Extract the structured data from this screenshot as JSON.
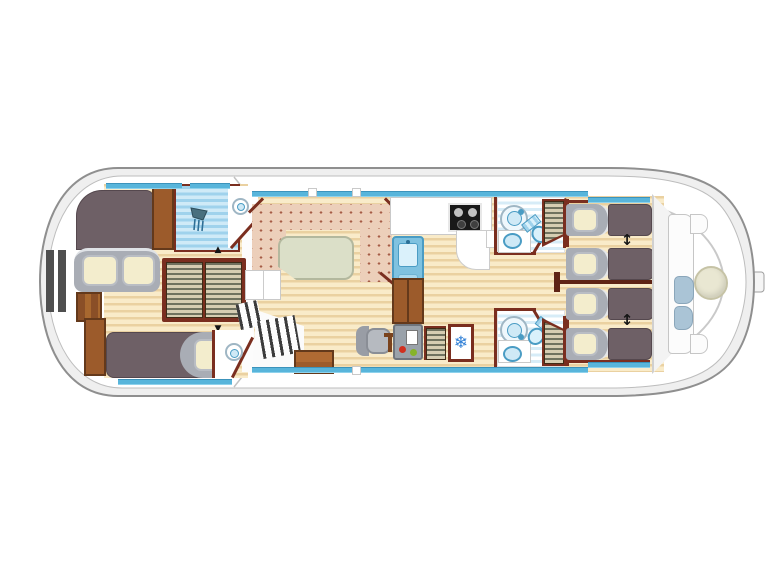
{
  "page": {
    "title": "Houseboat deck floor plan"
  },
  "diagram": {
    "type": "houseboat-floor-plan",
    "orientation": "bow-right",
    "rooms": [
      "aft-cabin",
      "aft-shower-room",
      "aft-toilet-room-top",
      "aft-toilet-room-bottom",
      "salon-dinette",
      "galley",
      "helm-station",
      "bathroom-fore-top",
      "bathroom-fore-bottom",
      "cabin-fore-top",
      "cabin-fore-bottom",
      "bow-deck"
    ],
    "fixtures": {
      "beds": {
        "aft_double": 1,
        "aft_single": 1,
        "fore_single_berths": 4
      },
      "showers": 3,
      "toilets": 4,
      "washbasins": 3,
      "louvered_wardrobes": 4,
      "stove_burners": 4,
      "refrigerators": 1,
      "dinette_tables": 1,
      "bow_tables": 1,
      "bow_bench_cushions": 2,
      "helm_seats": 1,
      "stern_ladder": 1,
      "sliding_berth_arrows": 2,
      "wardrobe_arrows": 2
    },
    "glyphs": {
      "snowflake": "❄",
      "updown": "↕",
      "tri_up": "▲",
      "tri_down": "▼"
    },
    "colors": {
      "hull_outline": "#8f8f8f",
      "hull_band": "#efefef",
      "interior": "#ffffff",
      "window_blue": "#58b5db",
      "wood_light": "#f9ebc9",
      "wood_stripe": "#ead1a1",
      "upholstery": "#eccfba",
      "upholstery_dot": "#a65c47",
      "table_green": "#dbdfc8",
      "wall_maroon": "#7a2e1f",
      "wood_furniture": "#9c5b2b",
      "wood_furniture_dark": "#64391b",
      "mattress": "#6e6066",
      "bed_head": "#a9adb5",
      "pillow": "#f3edcd",
      "bath_stripe": "#d7ecf7",
      "fixture_blue": "#cfe9f6",
      "fixture_accent": "#4a9cc4",
      "snowflake_blue": "#2f7fd6",
      "indicator_red": "#d03020",
      "indicator_green": "#86b32a",
      "bench_blue": "#aac4d6",
      "bow_table": "#e9e7d2",
      "louver_light": "#d6cdb2",
      "louver_dark": "#70725f",
      "console_gray": "#9aa2aa",
      "steel_gray": "#4f4f4f"
    }
  }
}
